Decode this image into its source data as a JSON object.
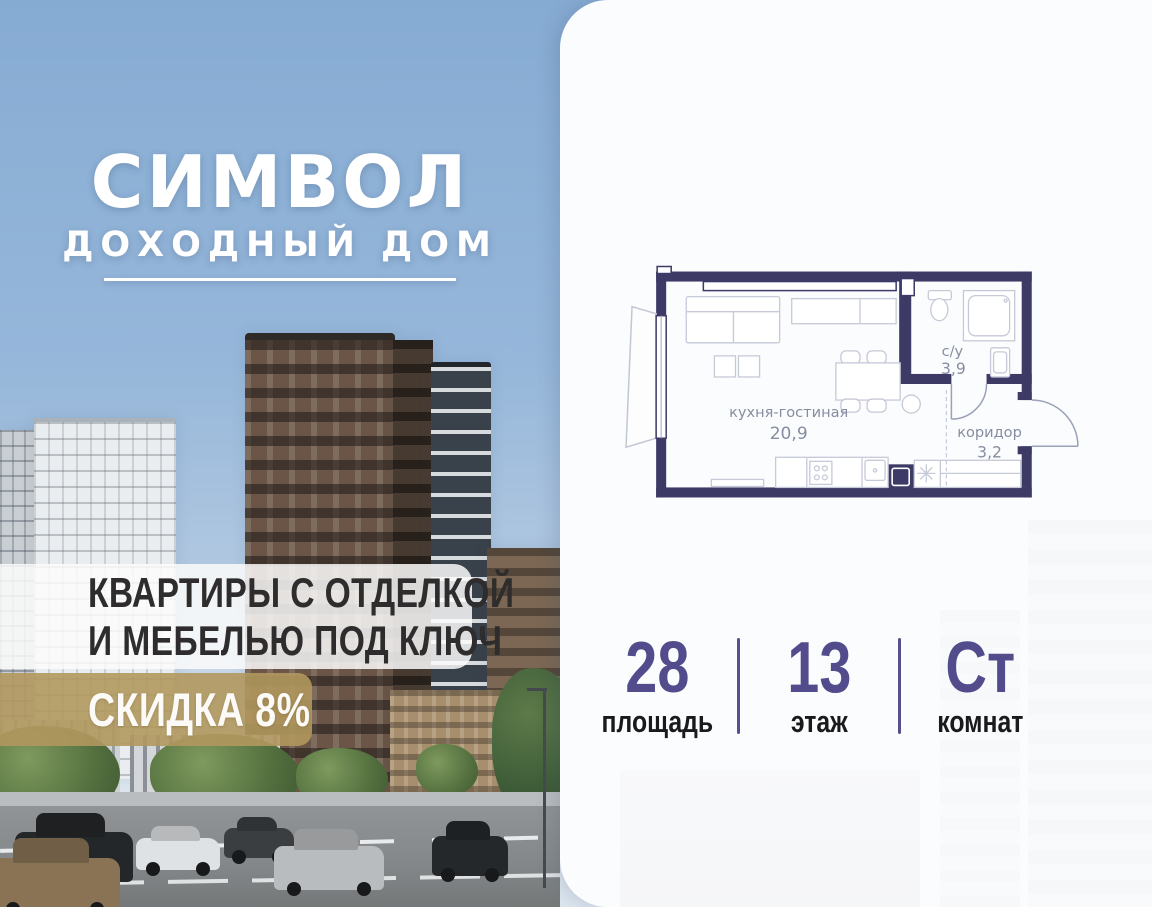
{
  "brand": {
    "title": "СИМВОЛ",
    "subtitle": "ДОХОДНЫЙ ДОМ"
  },
  "offer": {
    "line1": "КВАРТИРЫ С ОТДЕЛКОЙ",
    "line2": "И МЕБЕЛЬЮ ПОД КЛЮЧ",
    "discount": "СКИДКА 8%"
  },
  "floor_plan": {
    "rooms": [
      {
        "name": "кухня-гостиная",
        "area": "20,9"
      },
      {
        "name": "с/у",
        "area": "3,9"
      },
      {
        "name": "коридор",
        "area": "3,2"
      }
    ]
  },
  "stats": {
    "items": [
      {
        "value": "28",
        "label": "площадь"
      },
      {
        "value": "13",
        "label": "этаж"
      },
      {
        "value": "Ст",
        "label": "комнат"
      }
    ]
  },
  "colors": {
    "wall_navy": "#3d3a66",
    "accent_purple": "#524c8c",
    "badge_gold": "#b1985e",
    "sky_blue": "#86abd3",
    "plan_label_gray": "#878da1"
  }
}
